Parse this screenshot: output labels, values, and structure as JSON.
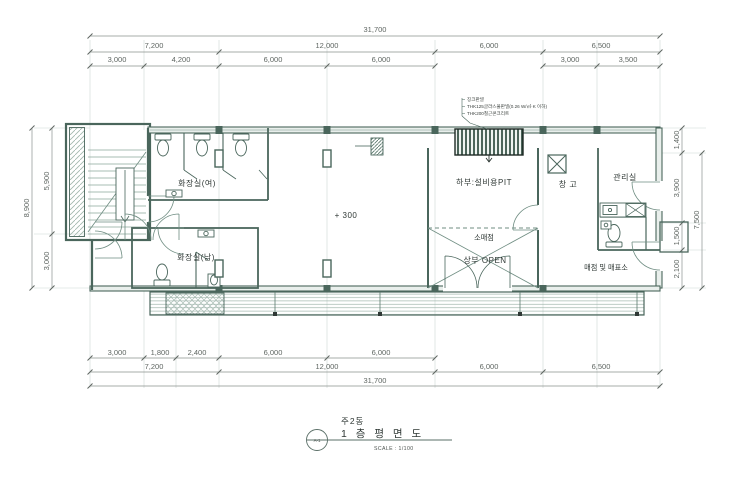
{
  "title_block": {
    "building": "주2동",
    "drawing_title": "1 층 평 면 도",
    "scale": "SCALE : 1/100",
    "sheet": "A-1"
  },
  "annotation": {
    "line1": "징크판넬",
    "line2": "THK125글라스울판넬(0.26 W/㎡·K 이하)",
    "line3": "THK200철근콘크리트"
  },
  "rooms": {
    "toilet_women": "화장실(여)",
    "toilet_men": "화장실(남)",
    "pit": "하부:설비용PIT",
    "storage": "창 고",
    "admin": "관리실",
    "retail": "소매점",
    "open_above": "상부 OPEN",
    "kiosk": "매점 및 매표소",
    "level": "+ 300"
  },
  "dims": {
    "top_total": "31,700",
    "top_row2": [
      "7,200",
      "12,000",
      "6,000",
      "6,500"
    ],
    "top_row3": [
      "3,000",
      "4,200",
      "6,000",
      "6,000",
      "3,000",
      "3,500"
    ],
    "bottom_row1": [
      "3,000",
      "1,800",
      "2,400",
      "6,000",
      "6,000"
    ],
    "bottom_row2": [
      "7,200",
      "12,000",
      "6,000",
      "6,500"
    ],
    "bottom_total": "31,700",
    "left": {
      "total": "8,900",
      "upper": "5,900",
      "lower": "3,000"
    },
    "right": {
      "top": "1,400",
      "total": "7,500",
      "a": "3,900",
      "b": "1,500",
      "c": "2,100"
    }
  },
  "colors": {
    "wall_line": "#4a665c",
    "thin_line": "#7a968a",
    "grid_line": "#c9d6d0",
    "dim_text": "#5f6662",
    "label_text": "#2f3835"
  }
}
